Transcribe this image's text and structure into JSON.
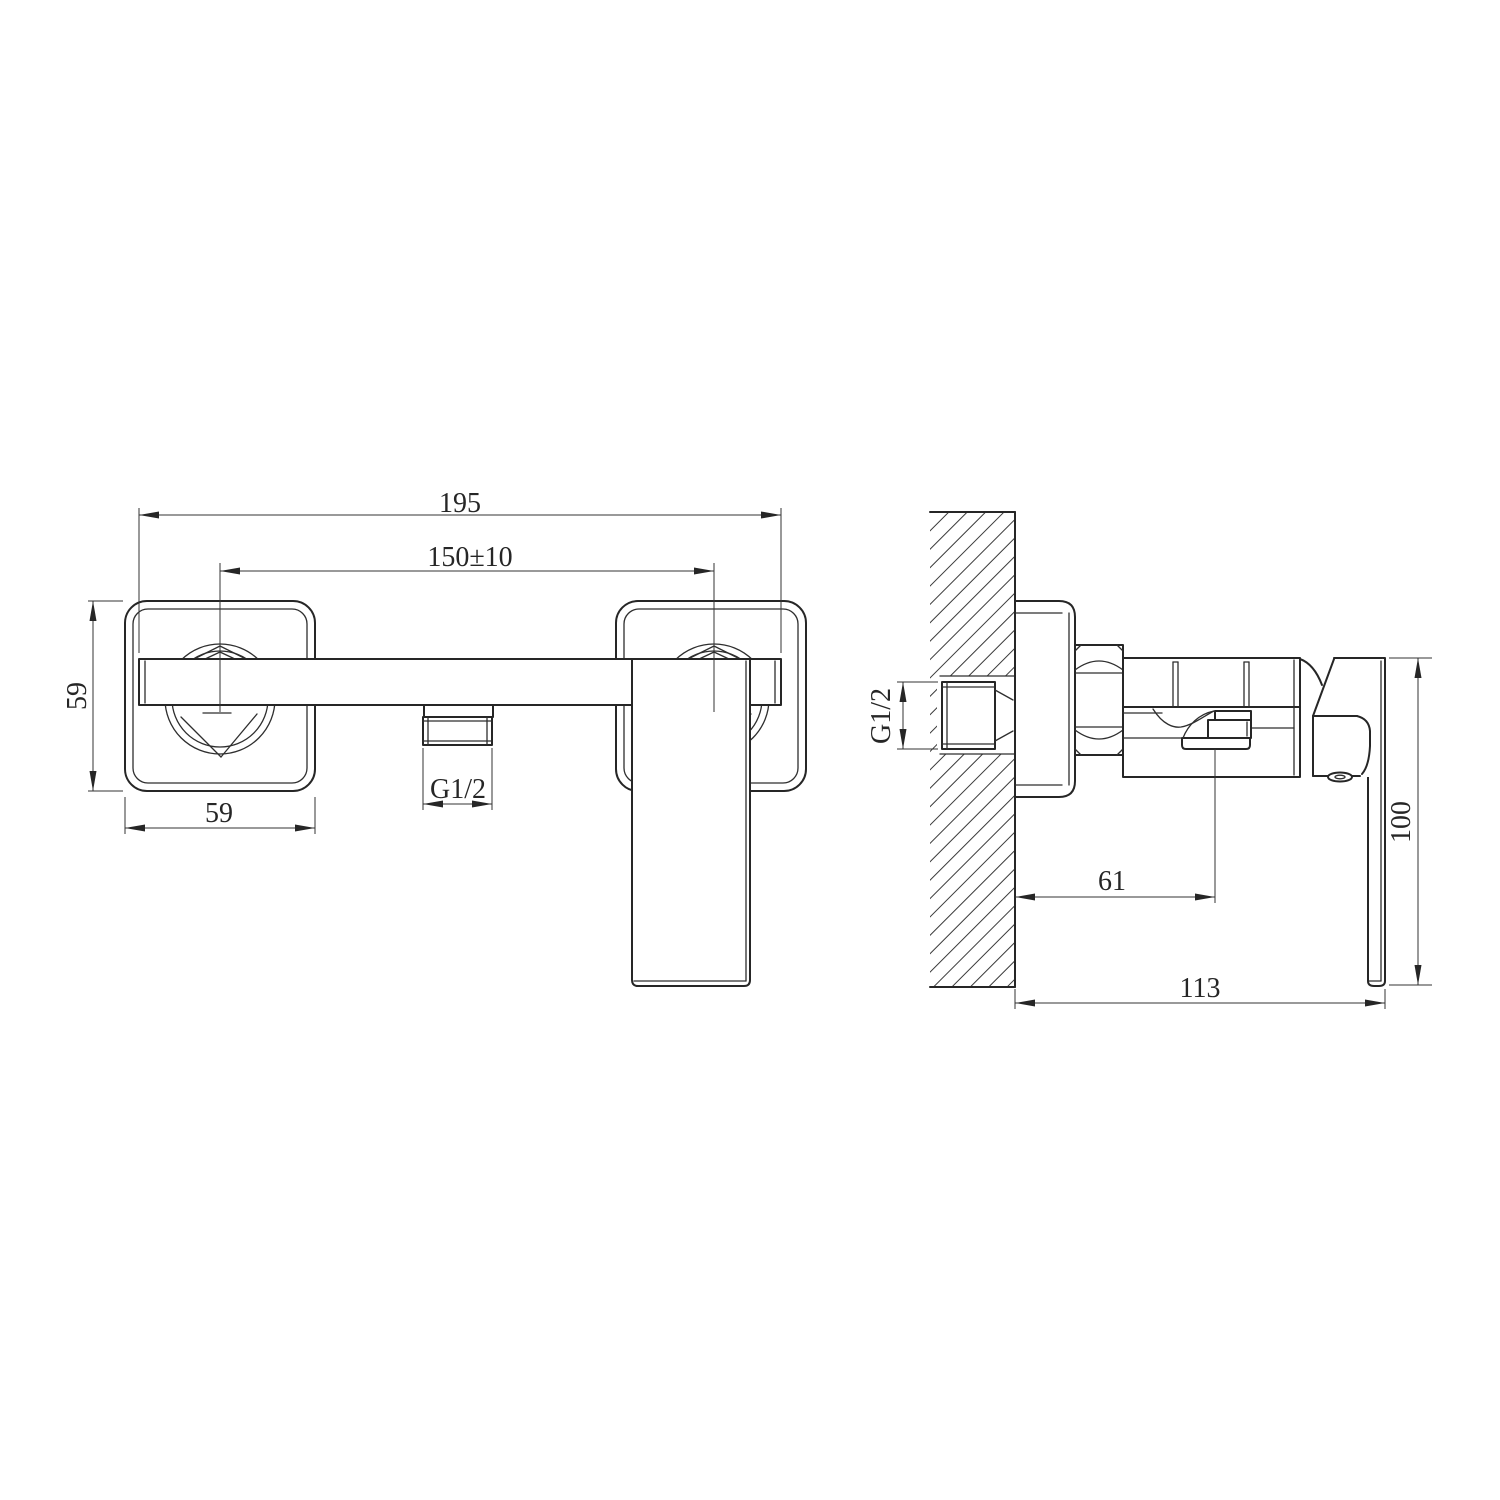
{
  "drawing": {
    "background": "#ffffff",
    "line_color": "#262626",
    "front_view": {
      "dim_overall_width": "195",
      "dim_hole_centers": "150±10",
      "dim_flange_height": "59",
      "dim_flange_width": "59",
      "dim_outlet_thread": "G1/2"
    },
    "side_view": {
      "dim_inlet_thread": "G1/2",
      "dim_wall_to_center": "61",
      "dim_handle_length": "100",
      "dim_wall_to_handle": "113"
    }
  }
}
